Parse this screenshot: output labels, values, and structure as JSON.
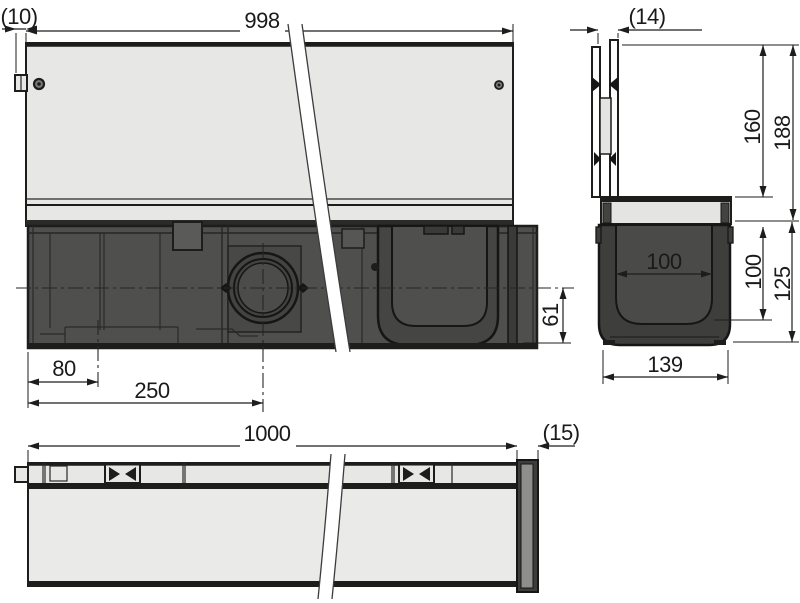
{
  "drawing_type": "drainage-channel-technical-drawing",
  "colors": {
    "background": "#ffffff",
    "outline": "#1d1d1b",
    "body_dark": "#4f4f4e",
    "channel_dark": "#3e3e3d",
    "panel_light": "#e7e7e6",
    "grate_light": "#e4e4e3",
    "cap_inner_gray": "#8e8e8d",
    "dim_text": "#1a1a1a"
  },
  "views": {
    "side": {
      "dims": {
        "length": "998",
        "tab": "(10)",
        "offset_a": "80",
        "offset_b": "250",
        "outlet_height": "61"
      }
    },
    "section": {
      "dims": {
        "thickness": "(14)",
        "upper_height": "160",
        "total_height": "188",
        "inner_width": "100",
        "inner_depth": "100",
        "channel_height": "125",
        "outer_width": "139"
      }
    },
    "plan": {
      "dims": {
        "length": "1000",
        "cap": "(15)"
      }
    }
  }
}
